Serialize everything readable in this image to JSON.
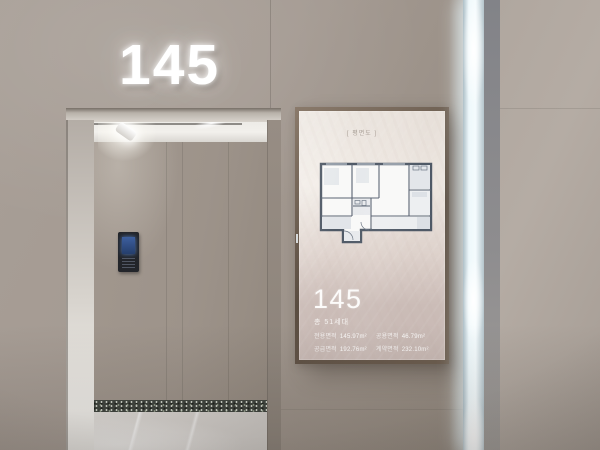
{
  "wall_sign": {
    "number": "145"
  },
  "display": {
    "top_label": "[ 평면도 ]",
    "unit_number": "145",
    "households": "총 51세대",
    "areas": [
      {
        "label": "전용면적",
        "value": "145.97m²"
      },
      {
        "label": "공용면적",
        "value": "46.79m²"
      },
      {
        "label": "공급면적",
        "value": "192.76m²"
      },
      {
        "label": "계약면적",
        "value": "232.10m²"
      }
    ]
  },
  "colors": {
    "wall-front": "#a49a92",
    "wall-front-deep": "#93897f",
    "wall-right": "#b5aca4",
    "wall-interior": "#9d938a",
    "ceiling": "#eceae6",
    "floor": "#d7d3cf",
    "terrazzo": "#3f443e",
    "led": "#eef8fb",
    "frame-bronze": "#5a4d41",
    "screen-top": "#ece6e0",
    "screen-bottom": "#cbbcb7",
    "plan-line": "#4f5966"
  }
}
